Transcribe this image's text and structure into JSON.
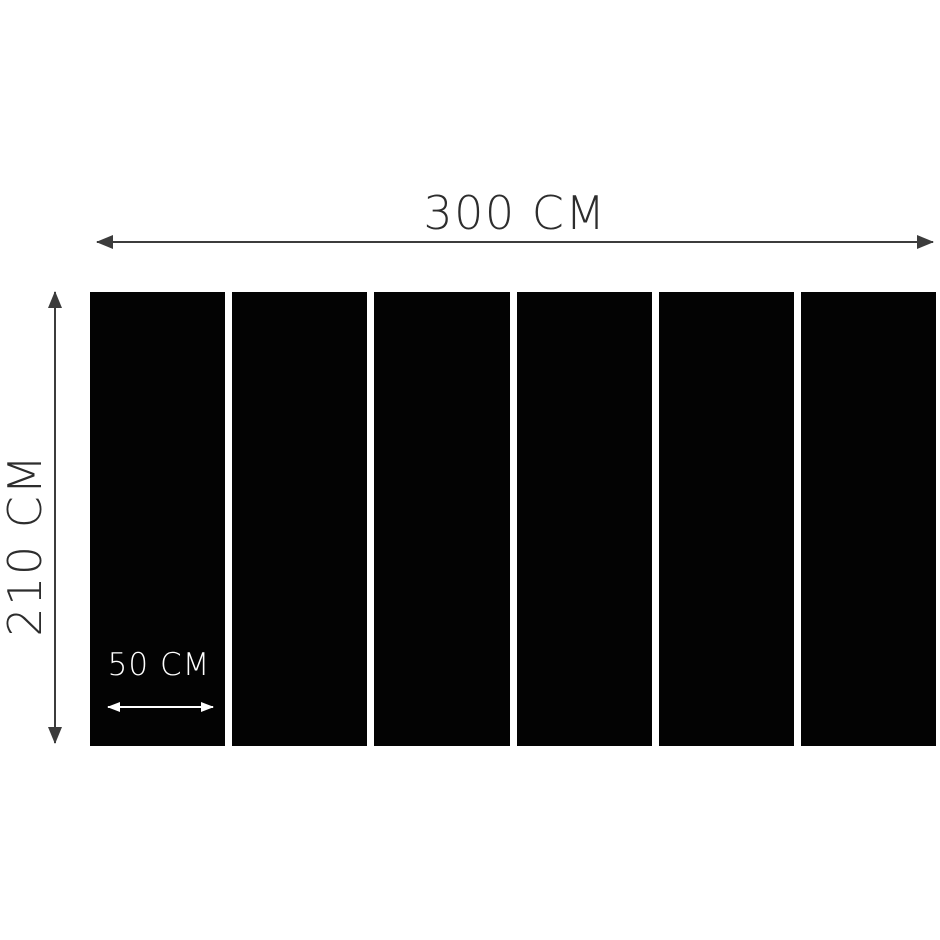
{
  "diagram": {
    "total_width_label": "300 CM",
    "height_label": "210 CM",
    "panel_width_label": "50 CM",
    "panel_count": 6
  },
  "icons": {
    "width_arrow": "double-headed-horizontal-dimension-arrow",
    "height_arrow": "double-headed-vertical-dimension-arrow",
    "panel_width_arrow": "double-headed-horizontal-dimension-arrow"
  },
  "colors": {
    "background": "#ffffff",
    "panel": "#030303",
    "dimension-line": "#3c3c3c",
    "label-text": "#2d2d2d",
    "panel-label": "#ffffff",
    "panel-arrow": "#ffffff"
  }
}
